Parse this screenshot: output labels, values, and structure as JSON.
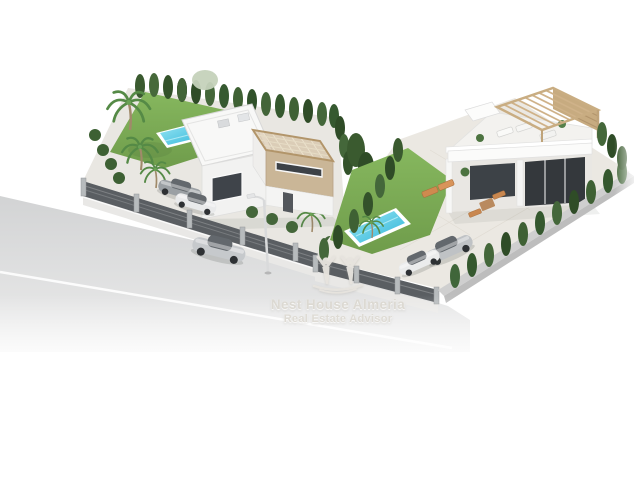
{
  "image": {
    "type": "3d-architectural-exterior-render",
    "description": "Aerial isometric render of two modern white villas on corner plots with pools, lawns, palm trees, cypress hedges, driveways with parked cars and a street with a passing silver car"
  },
  "watermark": {
    "brand": "Nest House Almeria",
    "tagline": "Real Estate Advisor",
    "logo": "two-people-logo",
    "text_color": "#dedbd4"
  },
  "palette": {
    "background": "#ffffff",
    "road": "#d2d3d4",
    "road_marking": "#ffffff",
    "sidewalk": "#e9e8e6",
    "lawn": "#7ead54",
    "hedge_green": "#3c5c31",
    "pool_water": "#45c1dd",
    "pool_rim": "#ffffff",
    "villa_wall": "#f6f6f5",
    "villa_accent_beige": "#c9b496",
    "pergola_wood": "#c9ad82",
    "glass_dark": "#3f444a",
    "fence_dark": "#5a5e62",
    "boundary_wall": "#cfcfcf",
    "car_silver": "#c6c9cc",
    "patio": "#ebe8e2",
    "lounger_orange": "#cf8a4f"
  },
  "scene": {
    "street": [
      "asphalt-road",
      "white-centre-line",
      "sidewalk",
      "street-lamp",
      "driving-silver-car"
    ],
    "plot_left": [
      "two-storey-villa",
      "roof-pergola",
      "swimming-pool",
      "lawn",
      "palm-trees",
      "cypress-hedge",
      "slat-fence",
      "two-parked-cars"
    ],
    "plot_right": [
      "single-storey-villa",
      "roof-terrace-pergola",
      "swimming-pool",
      "lawn",
      "sun-loungers",
      "cypress-hedge",
      "boundary-wall",
      "two-parked-cars"
    ]
  }
}
